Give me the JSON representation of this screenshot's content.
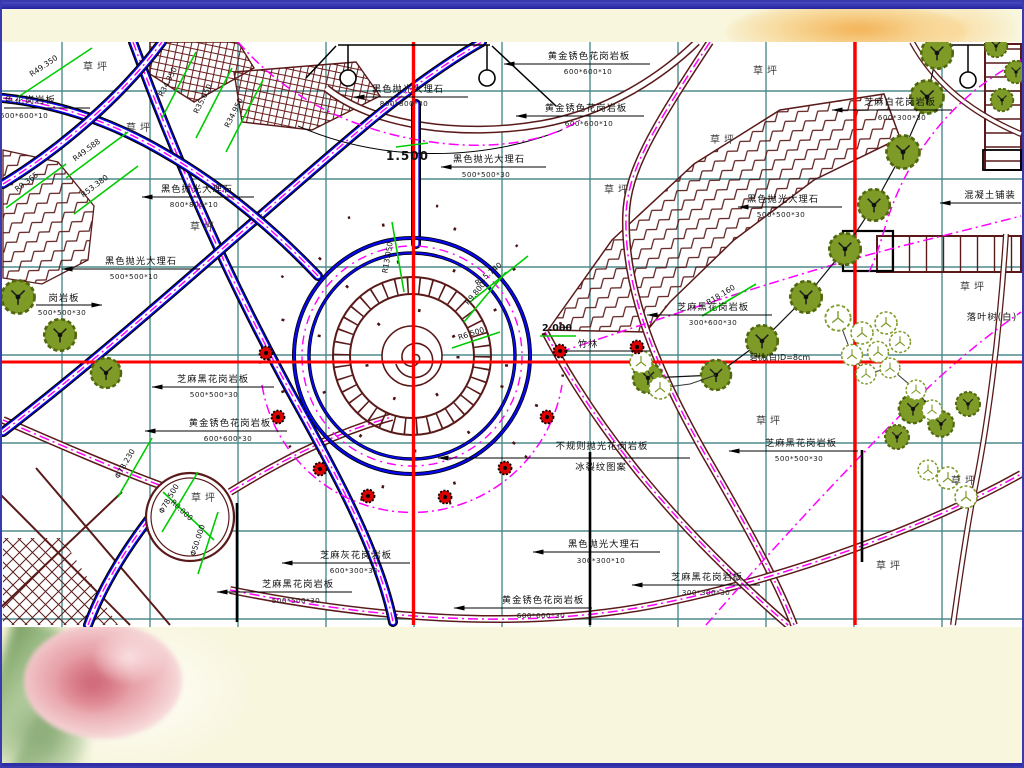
{
  "slide": {
    "frame_color": "#3A3AB0",
    "band_color": "#F8F6DC",
    "canvas_color": "#FFFFFF"
  },
  "plan": {
    "labels": {
      "lawn": "草坪",
      "grove": "竹林",
      "peach_tree": "碧桃(白)D=8cm",
      "deciduous_tree": "落叶树(白)",
      "concrete": "混凝土铺装"
    },
    "elevations": [
      "1.500",
      "2.000"
    ],
    "materials": [
      {
        "text": "黑色抛光大理石",
        "dim": "800*800*30"
      },
      {
        "text": "黑色抛光大理石",
        "dim": "500*500*30"
      },
      {
        "text": "黄金锈色花岗岩板",
        "dim": "600*600*10"
      },
      {
        "text": "黄金锈色花岗岩板",
        "dim": "600*600*10"
      },
      {
        "text": "黑色抛光大理石",
        "dim": "800*800*10"
      },
      {
        "text": "黑色抛光大理石",
        "dim": "500*500*10"
      },
      {
        "text": "色花岗岩板",
        "dim": "600*600*10"
      },
      {
        "text": "岗岩板",
        "dim": "500*500*30"
      },
      {
        "text": "芝麻黑花岗岩板",
        "dim": "500*500*30"
      },
      {
        "text": "黄金锈色花岗岩板",
        "dim": "600*600*30"
      },
      {
        "text": "不规则抛光花岗岩板",
        "dim": "冰裂纹图案"
      },
      {
        "text": "黑色抛光大理石",
        "dim": "300*300*10"
      },
      {
        "text": "黄金锈色花岗岩板",
        "dim": "600*600*30"
      },
      {
        "text": "芝麻黑花岗岩板",
        "dim": "300*300*30"
      },
      {
        "text": "芝麻灰花岗岩板",
        "dim": "600*300*30"
      },
      {
        "text": "芝麻黑花岗岩板",
        "dim": "500*500*30"
      },
      {
        "text": "芝麻黑花岗岩板",
        "dim": "300*600*30"
      },
      {
        "text": "黑色抛光大理石",
        "dim": "500*500*30"
      },
      {
        "text": "芝麻黑花岗岩板",
        "dim": "500*500*30"
      },
      {
        "text": "芝麻白花岗岩板",
        "dim": "600*300*30"
      }
    ],
    "radius_dims": [
      "R49.350",
      "R34.350",
      "R35.650",
      "R34.950",
      "R49.588",
      "R53.380",
      "R9.365",
      "R13.050",
      "R15.740",
      "R6.500",
      "R9.800",
      "R18.160",
      "R8.000",
      "Φ78.230",
      "Φ78.500",
      "Φ50.000"
    ],
    "colors": {
      "grid": "#4E8B8B",
      "axis": "#FF0000",
      "road": "#0808E8",
      "walkway": "#5A1A1A",
      "centerline": "#FF00FF",
      "dimension": "#00CC00",
      "tree": "#7D9B26"
    }
  }
}
